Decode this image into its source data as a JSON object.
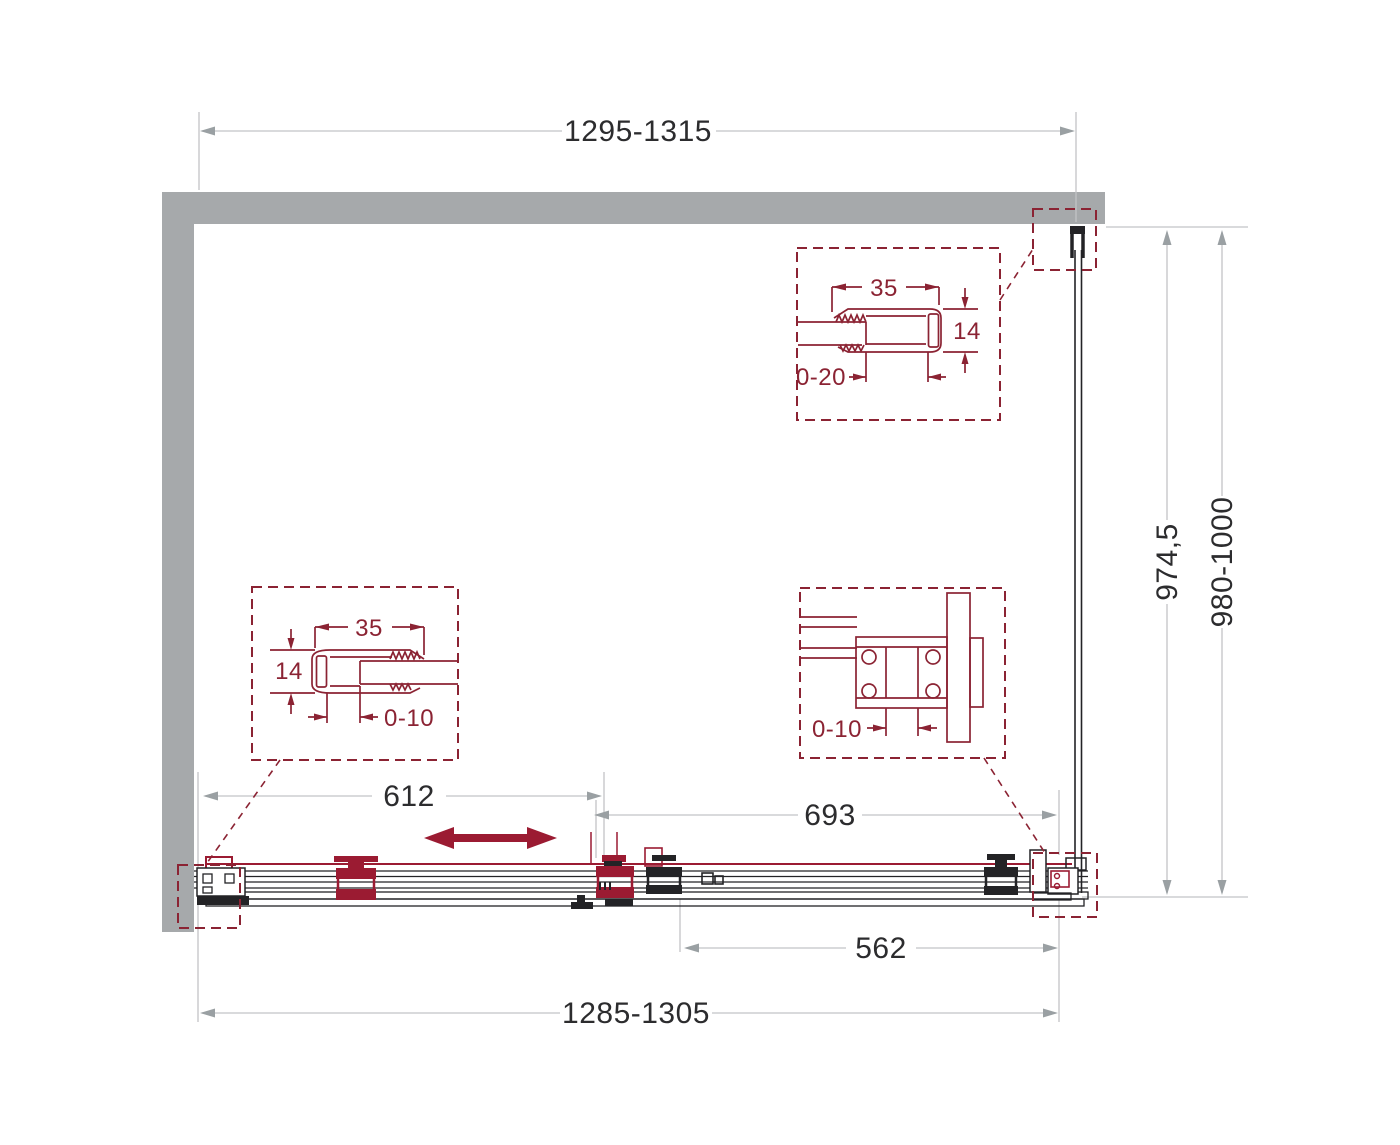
{
  "drawing": {
    "type": "technical-drawing",
    "subject": "sliding shower door enclosure — top plan view with profile details",
    "colors": {
      "accent_maroon": "#9b1b32",
      "detail_maroon": "#8b2333",
      "wall_gray": "#a6a9ab",
      "dimension_gray": "#c2c4c6",
      "line_black": "#232326",
      "text_black": "#2c2c2e"
    },
    "dimensions": {
      "top_width": "1295-1315",
      "bottom_width": "1285-1305",
      "door_panel_width": "612",
      "fixed_panel_width": "693",
      "opening_width": "562",
      "depth_inner": "974,5",
      "depth_overall": "980-1000"
    },
    "details": {
      "top_right": {
        "width": "35",
        "height": "14",
        "adjustment": "0-20"
      },
      "bottom_left": {
        "width": "35",
        "height": "14",
        "adjustment": "0-10"
      },
      "bottom_right": {
        "adjustment": "0-10"
      }
    }
  }
}
